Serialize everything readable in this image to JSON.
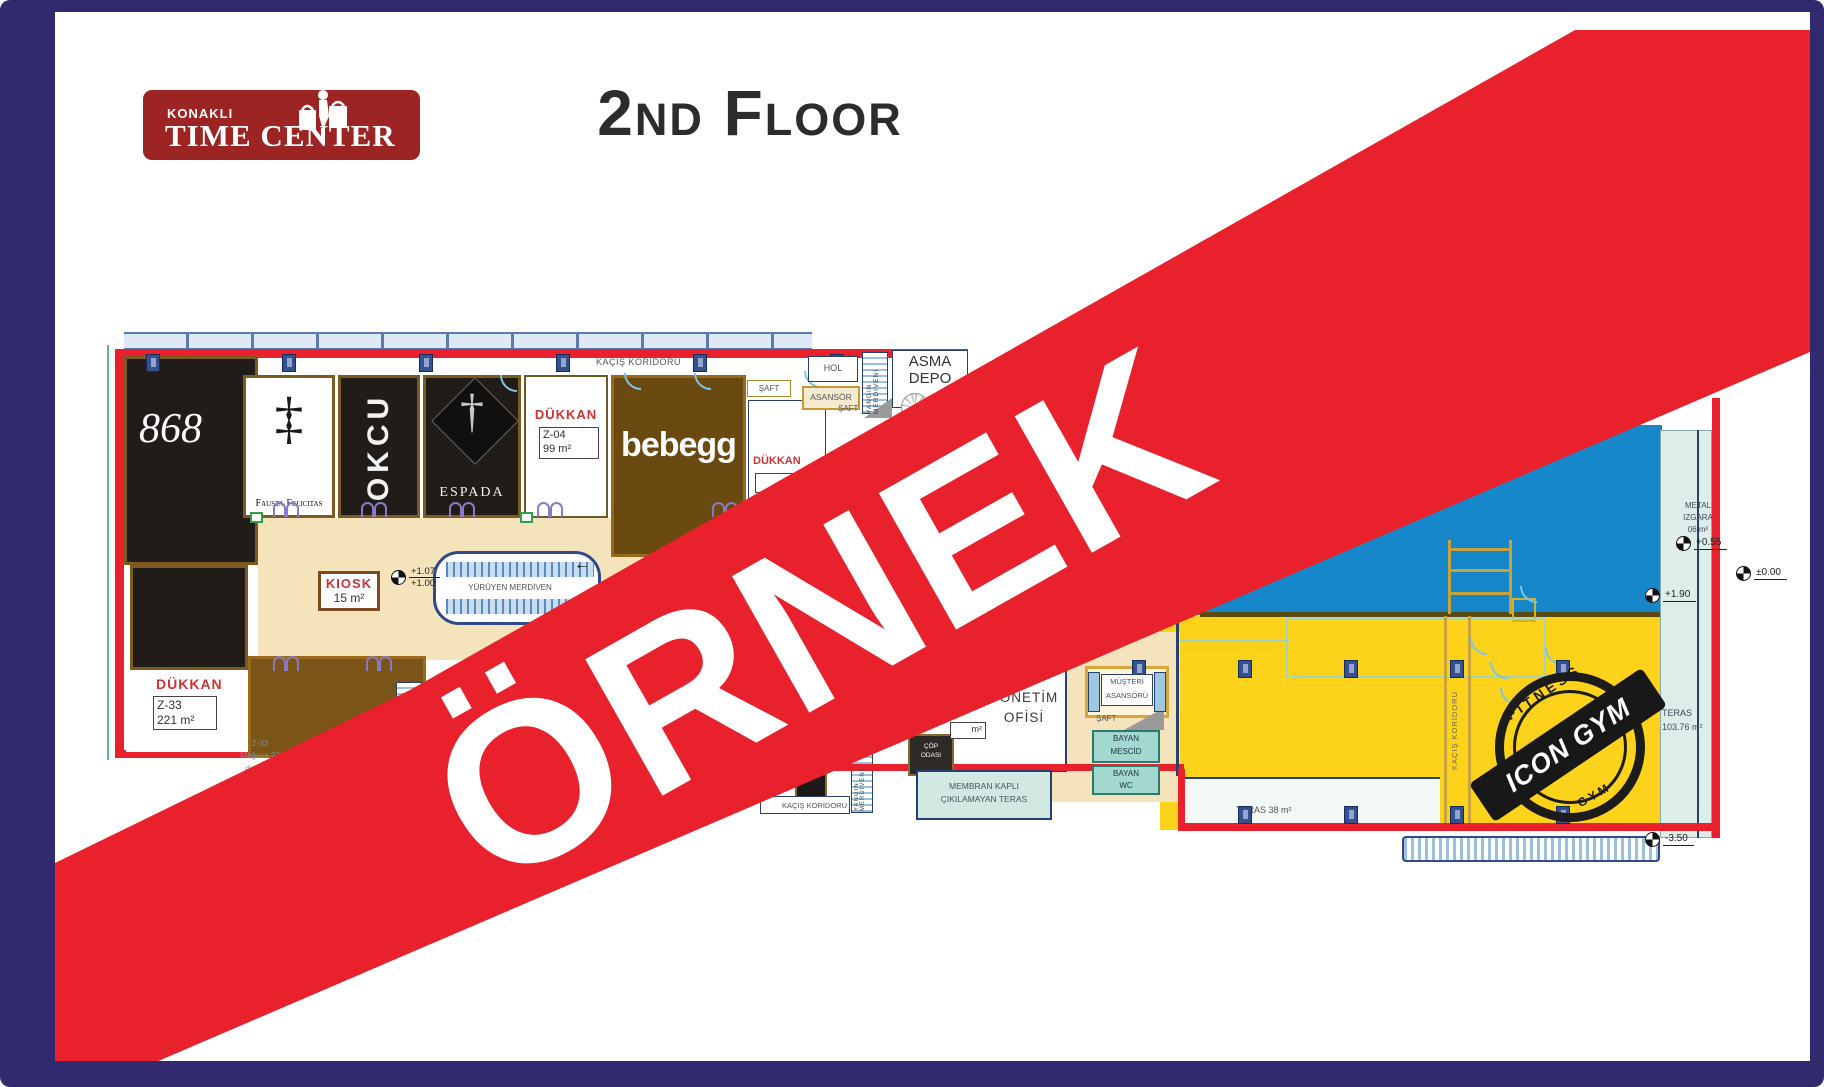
{
  "header": {
    "logo_line1": "KONAKLI",
    "logo_line2": "TIME CENTER",
    "title": "2nd Floor"
  },
  "banner": {
    "text": "ÖRNEK",
    "color": "#e8212d"
  },
  "stamp": {
    "arc_top": "FITNESS",
    "bar": "ICON GYM",
    "arc_bottom": "GYM"
  },
  "colors": {
    "frame": "#312a6e",
    "yellow_zone": "#fdd21a",
    "pool_blue": "#1687c8",
    "logo_red": "#9c2423"
  },
  "plan": {
    "corridor_top": "KAÇIŞ KORİDORU",
    "shops": {
      "s868": "868",
      "fausta": "Fausta Felicitas",
      "fausta_mono": "‡",
      "okcu": "OKCU",
      "espada": "ESPADA",
      "espada_dagger": "†",
      "bebegg": "bebegg"
    },
    "dukkan_z04": {
      "label": "DÜKKAN",
      "code": "Z-04",
      "area": "99 m²"
    },
    "dukkan_right": {
      "label": "DÜKKAN"
    },
    "dukkan_z33": {
      "label": "DÜKKAN",
      "code": "Z-33",
      "area": "221 m²",
      "note1": "Z-33",
      "note2": "Mağaza 23",
      "note3": "d:seram",
      "note4": "s: 1"
    },
    "kiosk": {
      "label": "KIOSK",
      "area": "15 m²"
    },
    "escalator": {
      "label": "YÜRÜYEN MERDİVEN",
      "arrow": "←"
    },
    "rooms": {
      "hol": "HOL",
      "asansor": "ASANSÖR",
      "yangin": "YANGIN MERDİVENİ",
      "saft": "ŞAFT",
      "asma_depo1": "ASMA",
      "asma_depo2": "DEPO",
      "yonetim1": "YÖNETİM",
      "yonetim2": "OFİSİ",
      "yonetim_area": "m²",
      "musteri1": "MÜŞTERİ",
      "musteri2": "ASANSÖRÜ",
      "bayan": "BAYAN",
      "mescid": "MESCİD",
      "wc": "WC",
      "cop1": "ÇÖP",
      "cop2": "ODASI",
      "membran1": "MEMBRAN KAPLI",
      "membran2": "ÇIKILAMAYAN TERAS",
      "koridor_box": "KAÇIŞ KORİDORU",
      "kacis_vertical": "KAÇIŞ KORİDORU"
    },
    "teras_right1": "TERAS",
    "teras_right2": "103.76 m²",
    "teras_bottom": "TERAS 38 m²",
    "metal1": "METAL",
    "metal2": "IZGARA",
    "metal3": "06 m²",
    "elevations": {
      "e107": "+1.07",
      "e100": "+1.00",
      "e055": "+0.55",
      "e000": "±0.00",
      "e190": "+1.90",
      "em350": "-3.50"
    }
  }
}
